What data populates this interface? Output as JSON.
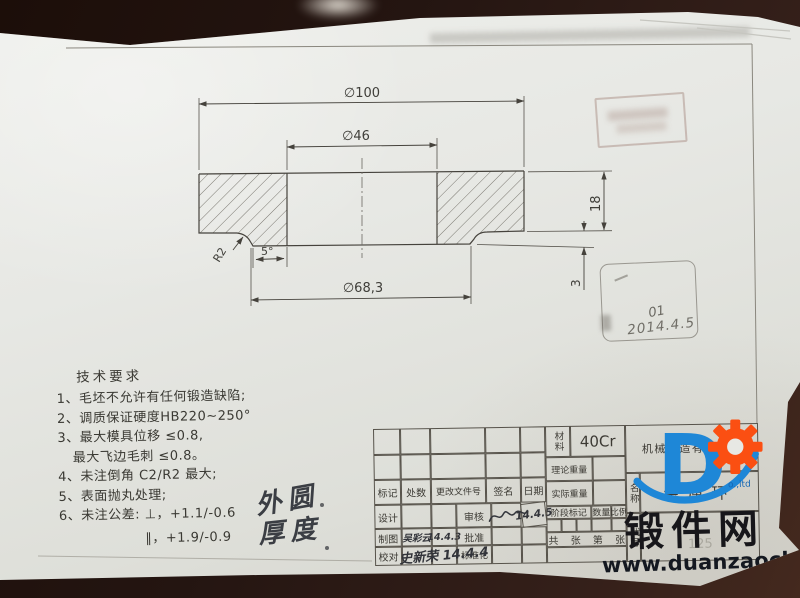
{
  "drawing": {
    "dim_outer_diameter": "∅100",
    "dim_bore_diameter": "∅46",
    "dim_flange_diameter": "∅68,3",
    "dim_height": "18",
    "dim_step": "3",
    "dim_draft_angle": "5°",
    "dim_fillet_radius": "R2"
  },
  "tech_requirements": {
    "title": "技术要求",
    "items": [
      "1、毛坯不允许有任何锻造缺陷;",
      "2、调质保证硬度HB220~250°",
      "3、最大模具位移 ≤0.8,",
      "最大飞边毛刺 ≤0.8。",
      "4、未注倒角 C2/R2 最大;",
      "5、表面抛丸处理;",
      "6、未注公差: ⊥，+1.1/-0.6",
      "∥，+1.9/-0.9"
    ],
    "handwritten_note_1": "外圆",
    "handwritten_note_2": "厚度"
  },
  "title_block": {
    "header_mark": "标记",
    "header_count": "处数",
    "header_doc": "更改文件号",
    "header_sign": "签名",
    "header_date": "日期",
    "material_label": "材料",
    "material_value": "40Cr",
    "theoretical_weight_label": "理论重量",
    "actual_weight_label": "实际重量",
    "stage_label": "阶段标记",
    "qty_label": "数量",
    "scale_label": "比例",
    "design_label": "设计",
    "review_label": "审核",
    "review_date": "14.4.5",
    "draft_label": "制图",
    "draft_name": "吴彩云",
    "draft_date": "14.4.3",
    "approve_label": "批准",
    "check_label": "校对",
    "check_entry": "史新荣 14.4.4",
    "standard_label": "标准化",
    "sheets_text": "共 张 第 张",
    "company_name": "机械锻造有限公司",
    "name_label": "名称",
    "part_name": "金属环",
    "code_label": "代号",
    "code_value": "125"
  },
  "stamps": {
    "round_stamp_number": "01",
    "round_stamp_date": "2014.4.5"
  },
  "watermark": {
    "logo_letter": "D",
    "logo_sub": "o.,ltd",
    "site_name": "锻件网",
    "site_url": "www.duanzaochina.com",
    "blue": "#1e87d7",
    "orange": "#fb4f12"
  }
}
